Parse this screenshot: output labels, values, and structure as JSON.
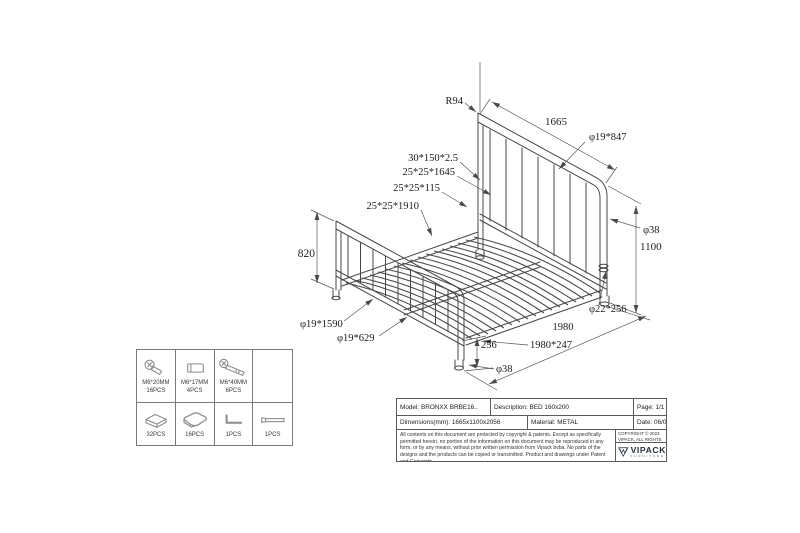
{
  "drawing": {
    "annotations": {
      "r94": "R94",
      "headboard_width": "1665",
      "headboard_bar": "φ19*847",
      "post_dia_right": "φ38",
      "headboard_height": "1100",
      "slat": "30*150*2.5",
      "cross_tube_1645": "25*25*1645",
      "connector_115": "25*25*115",
      "side_tube_1910": "25*25*1910",
      "footboard_height": "820",
      "footboard_tube_1590": "φ19*1590",
      "footboard_bar_629": "φ19*629",
      "leg_height_256": "256",
      "post_dia_front": "φ38",
      "leg_tube": "φ22*256",
      "bed_length": "1980",
      "side_rail": "1980*247"
    }
  },
  "parts_table": {
    "row1": [
      {
        "icon": "bolt-short-icon",
        "spec": "M6*20MM",
        "qty": "16PCS"
      },
      {
        "icon": "barrel-nut-icon",
        "spec": "M6*17MM",
        "qty": "4PCS"
      },
      {
        "icon": "bolt-long-icon",
        "spec": "M6*40MM",
        "qty": "6PCS"
      },
      {
        "icon": "",
        "spec": "",
        "qty": ""
      }
    ],
    "row2": [
      {
        "icon": "plastic-cap-icon",
        "qty": "32PCS"
      },
      {
        "icon": "plastic-glide-icon",
        "qty": "16PCS"
      },
      {
        "icon": "allen-key-icon",
        "qty": "1PCS"
      },
      {
        "icon": "wrench-icon",
        "qty": "1PCS"
      }
    ]
  },
  "title_block": {
    "model": "Model: BRONXX BRBE16..",
    "description": "Description: BED 160x200",
    "page": "Page: 1/1",
    "dimensions": "Dimensions(mm): 1665x1100x2056",
    "material": "Material: METAL",
    "date": "Date: 06/03/2023",
    "legal": "All contents on this document are protected by copyright & patents. Except as specifically permitted herein, no portion of the information on this document may be reproduced in any form, or by any means, without prior written permission from Vipack bvba. No parts of the designs and the products can be copied or transmitted. Product and drawings under Patent and Copyright.",
    "copyright": "COPYRIGHT © 2023 VIPACK, ALL RIGHTS RESERVED",
    "logo": {
      "brand": "VIPACK",
      "sub": "FURNITURE"
    }
  }
}
